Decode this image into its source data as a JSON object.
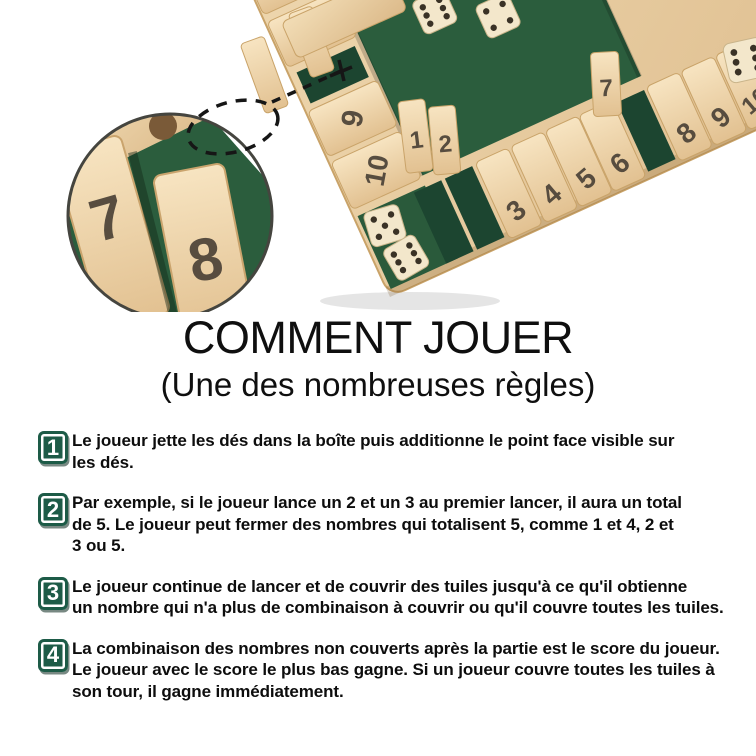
{
  "photo": {
    "description": "wooden shut-the-box four-player game board with green felt, numbered tiles and dice; magnified circle detail of tiles 7 and 8",
    "bottom_tiles": [
      "1",
      "2",
      "3",
      "4",
      "5",
      "6",
      "7",
      "8",
      "9",
      "10"
    ],
    "left_tiles": [
      "4",
      "6",
      "9",
      "10"
    ],
    "magnifier_tiles": [
      "7",
      "8"
    ],
    "dice_values": {
      "felt": [
        6,
        4
      ],
      "tray": [
        5,
        6
      ],
      "edge": [
        6
      ]
    },
    "colors": {
      "felt_green": "#2b5d3d",
      "wood_light": "#f2ddb6",
      "wood_dark": "#dcba8a",
      "slot_green": "#1c4530"
    }
  },
  "title": "COMMENT JOUER",
  "subtitle": "(Une des nombreuses règles)",
  "badge_color": "#1d5b47",
  "steps": [
    {
      "number": "1",
      "lines": [
        "Le joueur jette les dés dans la boîte puis additionne le point face visible sur",
        "les dés."
      ]
    },
    {
      "number": "2",
      "lines": [
        "Par exemple, si le joueur lance un 2 et un 3 au premier lancer, il aura un total",
        "de 5. Le joueur peut fermer des nombres qui totalisent 5, comme 1 et 4, 2 et",
        "3 ou 5."
      ]
    },
    {
      "number": "3",
      "lines": [
        "Le joueur continue de lancer et de couvrir des tuiles jusqu'à ce qu'il obtienne",
        "un nombre qui n'a plus de combinaison à couvrir ou qu'il couvre toutes les tuiles."
      ]
    },
    {
      "number": "4",
      "lines": [
        "La combinaison des nombres non couverts après la partie est le score du joueur.",
        "Le joueur avec le score le plus bas gagne. Si un joueur couvre toutes les tuiles à",
        "son tour, il gagne immédiatement."
      ]
    }
  ]
}
